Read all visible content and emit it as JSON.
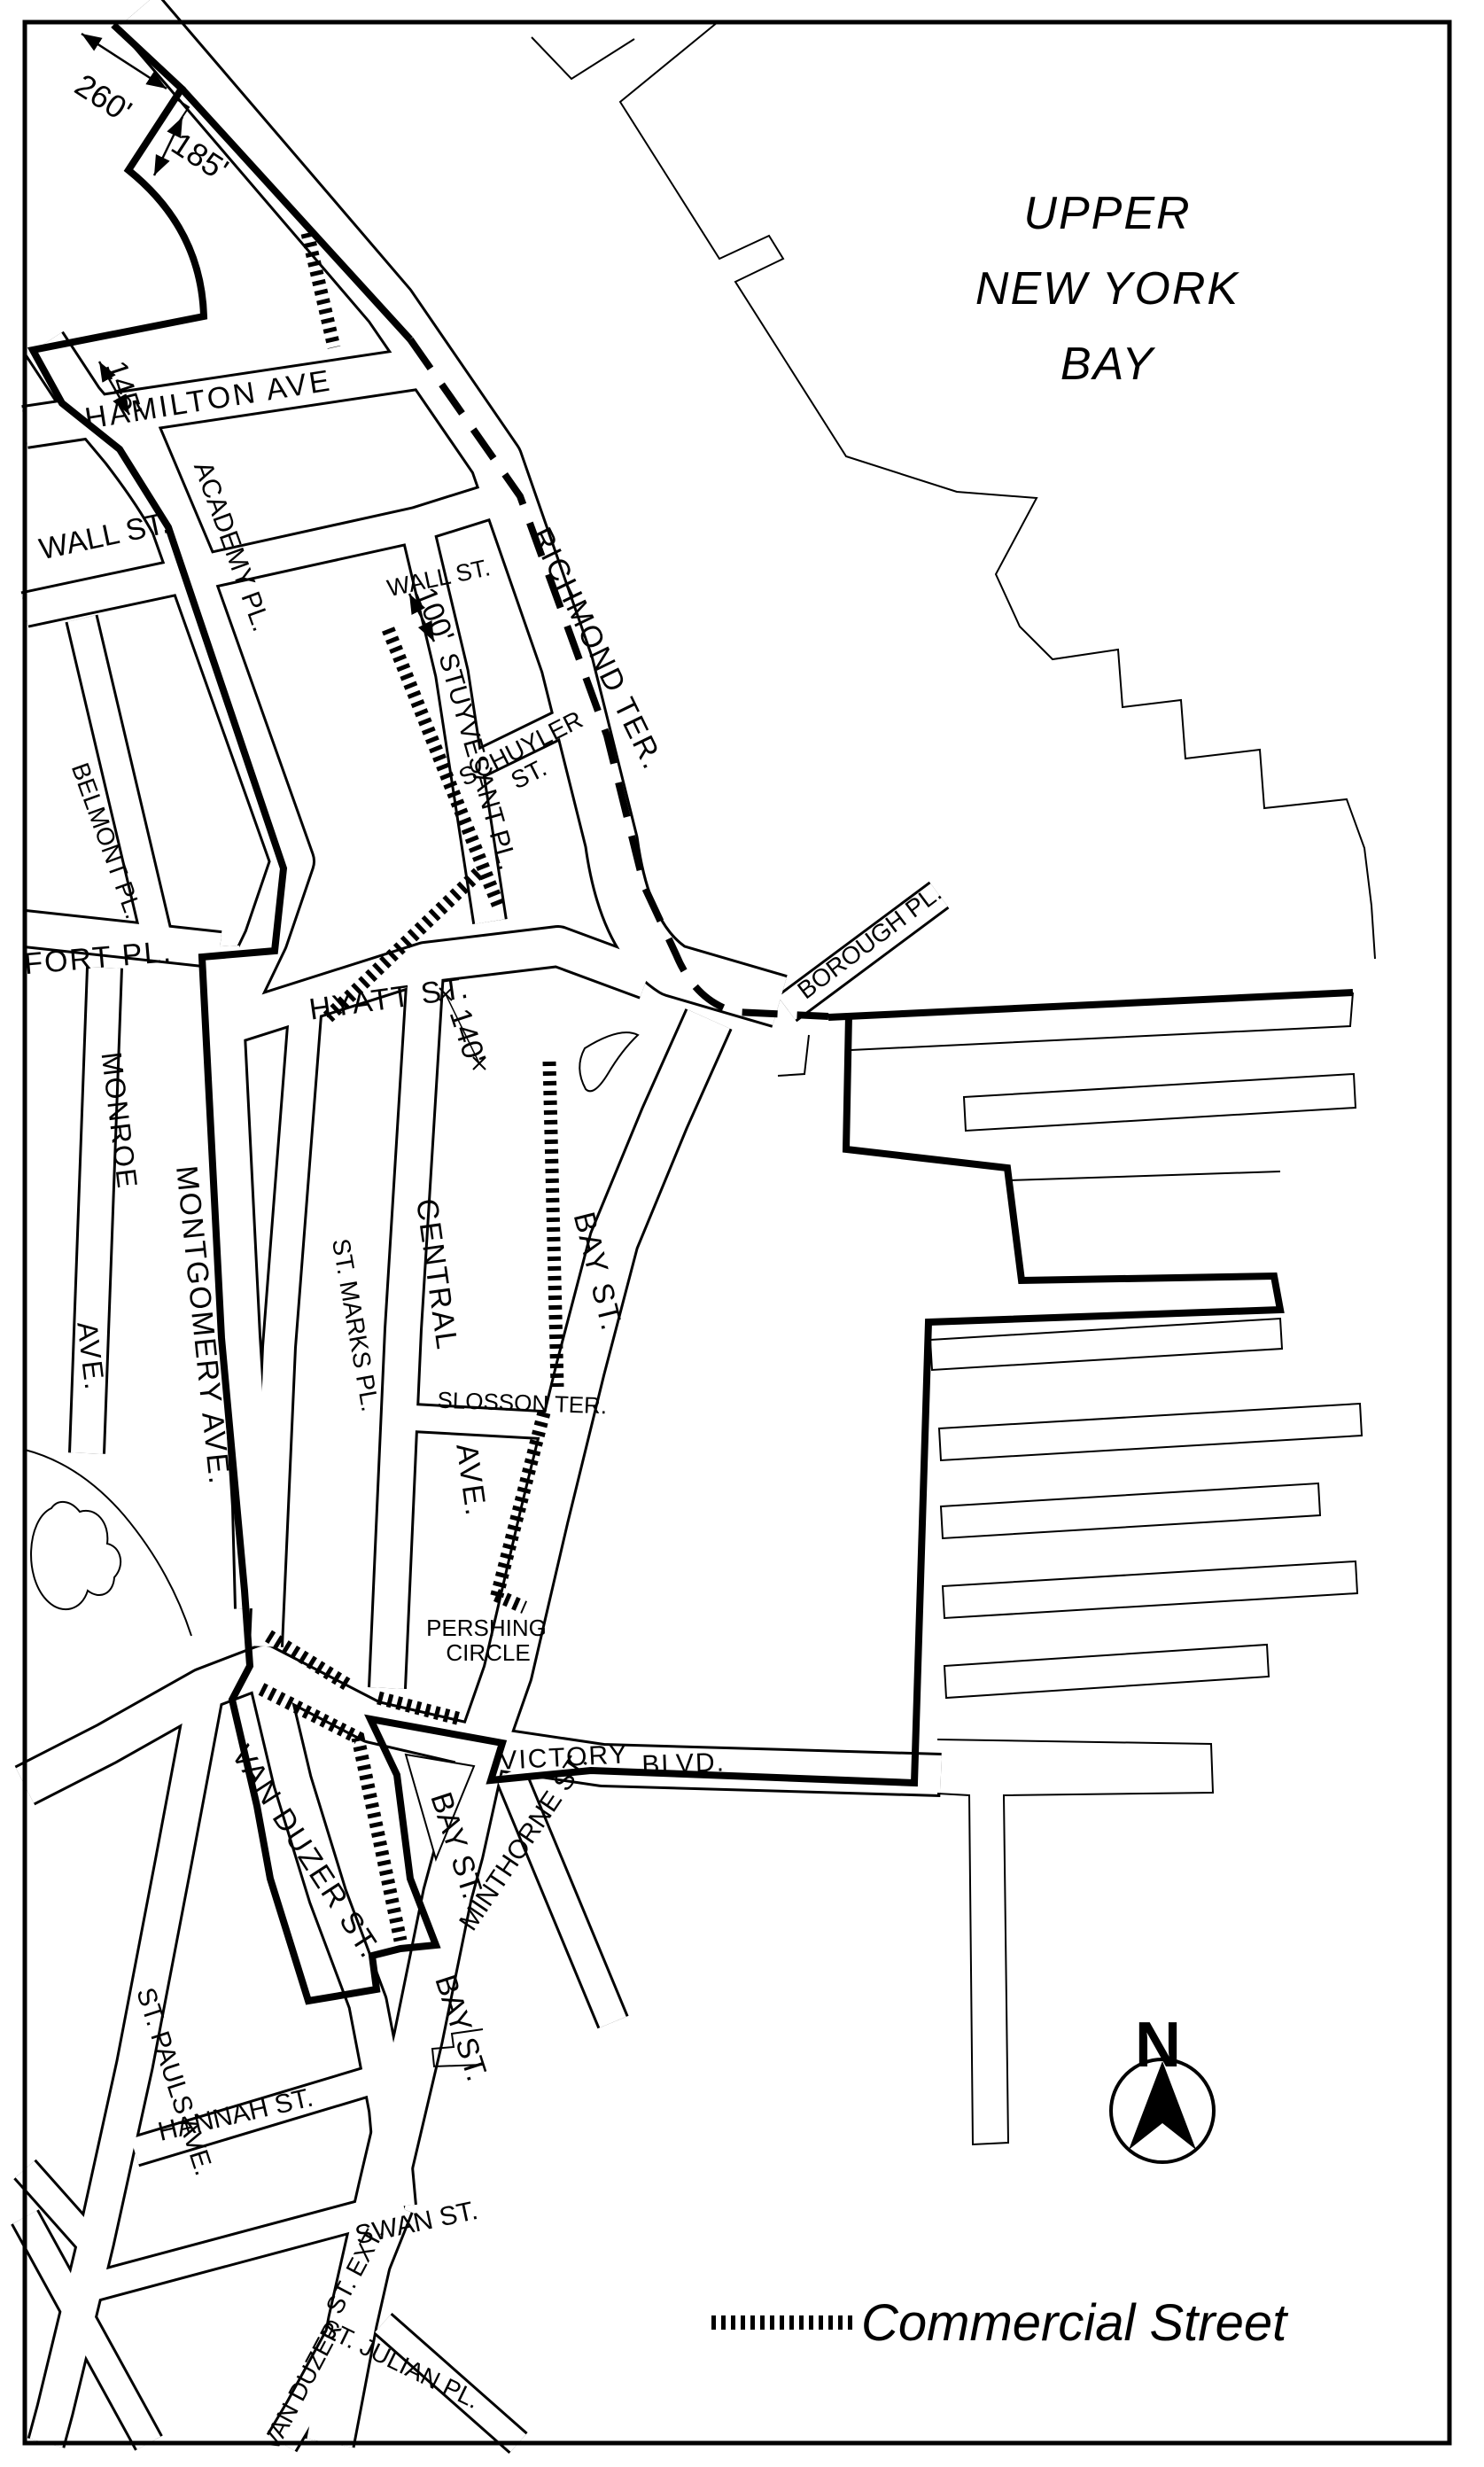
{
  "map": {
    "water_label": {
      "line1": "UPPER",
      "line2": "NEW YORK",
      "line3": "BAY"
    },
    "legend": {
      "label": "Commercial Street"
    },
    "compass": {
      "north_label": "N"
    },
    "colors": {
      "ink": "#000000",
      "paper": "#ffffff"
    },
    "dimension_labels": [
      {
        "id": "dim-260",
        "text": "260'"
      },
      {
        "id": "dim-185",
        "text": "185'"
      },
      {
        "id": "dim-145",
        "text": "145'"
      },
      {
        "id": "dim-100",
        "text": "100'"
      },
      {
        "id": "dim-140",
        "text": "140'"
      }
    ],
    "street_labels": [
      {
        "id": "hamilton-ave",
        "text": "HAMILTON AVE"
      },
      {
        "id": "richmond-ter",
        "text": "RICHMOND TER."
      },
      {
        "id": "academy-pl",
        "text": "ACADEMY PL."
      },
      {
        "id": "wall-st-west",
        "text": "WALL ST."
      },
      {
        "id": "wall-st-east",
        "text": "WALL ST."
      },
      {
        "id": "stuyvesant-pl",
        "text": "STUYVESANT PL."
      },
      {
        "id": "schuyler",
        "text": "SCHUYLER"
      },
      {
        "id": "schuyler-st",
        "text": "ST."
      },
      {
        "id": "belmont-pl",
        "text": "BELMONT PL."
      },
      {
        "id": "fort-pl",
        "text": "FORT PL."
      },
      {
        "id": "monroe",
        "text": "MONROE"
      },
      {
        "id": "monroe-ave",
        "text": "AVE."
      },
      {
        "id": "montgomery-ave",
        "text": "MONTGOMERY AVE."
      },
      {
        "id": "st-marks-pl",
        "text": "ST. MARKS PL."
      },
      {
        "id": "central",
        "text": "CENTRAL"
      },
      {
        "id": "central-ave",
        "text": "AVE."
      },
      {
        "id": "hyatt-st",
        "text": "HYATT ST."
      },
      {
        "id": "bay-st-upper",
        "text": "BAY ST."
      },
      {
        "id": "borough-pl",
        "text": "BOROUGH PL."
      },
      {
        "id": "slosson-ter",
        "text": "SLOSSON TER."
      },
      {
        "id": "pershing",
        "text": "PERSHING"
      },
      {
        "id": "circle",
        "text": "CIRCLE"
      },
      {
        "id": "victory",
        "text": "VICTORY"
      },
      {
        "id": "blvd",
        "text": "BLVD."
      },
      {
        "id": "van-duzer-st",
        "text": "VAN DUZER ST."
      },
      {
        "id": "bay-st-mid",
        "text": "BAY ST."
      },
      {
        "id": "minthorne-st",
        "text": "MINTHORNE ST."
      },
      {
        "id": "st-pauls-ave",
        "text": "ST. PAULS AVE."
      },
      {
        "id": "hannah-st",
        "text": "HANNAH ST."
      },
      {
        "id": "swan-st",
        "text": "SWAN ST."
      },
      {
        "id": "bay-st-lower",
        "text": "BAY ST."
      },
      {
        "id": "van-duzer-ext-1",
        "text": "VAN DUZER"
      },
      {
        "id": "van-duzer-ext-2",
        "text": "ST. EXT."
      },
      {
        "id": "st-julian-pl",
        "text": "ST. JULIAN PL."
      }
    ]
  }
}
